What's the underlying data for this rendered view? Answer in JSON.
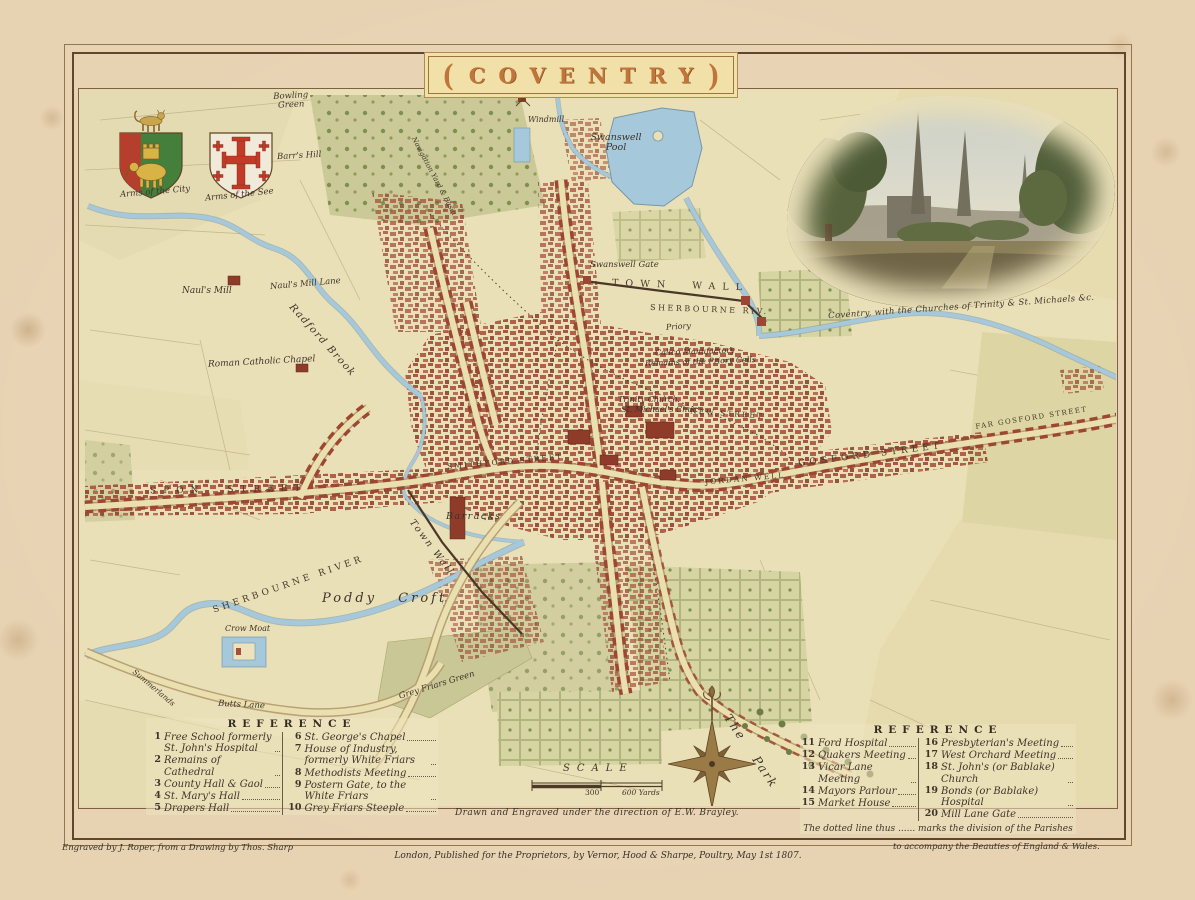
{
  "palette": {
    "paper": "#e7d2b2",
    "map_ground": "#eae0b8",
    "buildings": "#a5503a",
    "water": "#a6c8db",
    "greens": "#b9bf8a",
    "frame_ink": "#5f462c",
    "banner_text": "#c0763a",
    "label_ink": "#3e342a"
  },
  "title_banner": {
    "left_bracket": "(",
    "text": "COVENTRY",
    "right_bracket": ")"
  },
  "arms": {
    "city_label": "Arms of the City",
    "see_label": "Arms of the See"
  },
  "vignette": {
    "caption": "Coventry, with the Churches of Trinity & St. Michaels &c."
  },
  "map_labels": {
    "bowling_green": "Bowling Green",
    "barrs_hill": "Barr's Hill",
    "windmill": "Windmill",
    "swanswell_pool": "Swanswell Pool",
    "navigation_yard": "Navigation Yard & Basin",
    "nauls_mill": "Naul's Mill",
    "nauls_mill_lane": "Naul's Mill Lane",
    "radford_brook": "Radford Brook",
    "roman_catholic_chapel": "Roman Catholic Chapel",
    "swanswell_gate": "Swanswell Gate",
    "town_wall_north": "TOWN WALL",
    "sherbourne_riv": "SHERBOURNE RIV.",
    "priory": "Priory",
    "calico_manufactory": "Calico Manufactory",
    "priory_cells": "Remains of the Priory Cells",
    "trinity_church": "Trinity Church",
    "st_michaels": "St. Michael's Chur.",
    "new_street": "NEW STREET",
    "spon_street": "SPON STREET",
    "smithford_street": "SMITHFORD STREET",
    "jordan_well": "JORDAN WELL",
    "gosford_street": "GOSFORD STREET",
    "far_gosford_street": "FAR GOSFORD STREET",
    "barracks": "Barracks",
    "town_wall_south": "Town Wall",
    "sherbourne_river": "SHERBOURNE RIVER",
    "poddy_croft": "Poddy Croft",
    "crow_moat": "Crow Moat",
    "summerlands": "Summerlands",
    "butts_lane": "Butts Lane",
    "grey_friars_green": "Grey Friars Green",
    "the_park": "The Park"
  },
  "scale": {
    "title": "SCALE",
    "mid_value": "300",
    "end_value": "600 Yards"
  },
  "reference_left": {
    "title": "REFERENCE",
    "col1": [
      {
        "num": "1",
        "text": "Free School formerly St. John's Hospital"
      },
      {
        "num": "2",
        "text": "Remains of Cathedral"
      },
      {
        "num": "3",
        "text": "County Hall & Gaol"
      },
      {
        "num": "4",
        "text": "St. Mary's Hall"
      },
      {
        "num": "5",
        "text": "Drapers Hall"
      }
    ],
    "col2": [
      {
        "num": "6",
        "text": "St. George's Chapel"
      },
      {
        "num": "7",
        "text": "House of Industry, formerly White Friars"
      },
      {
        "num": "8",
        "text": "Methodists Meeting"
      },
      {
        "num": "9",
        "text": "Postern Gate, to the White Friars"
      },
      {
        "num": "10",
        "text": "Grey Friars Steeple"
      }
    ]
  },
  "reference_right": {
    "title": "REFERENCE",
    "col1": [
      {
        "num": "11",
        "text": "Ford Hospital"
      },
      {
        "num": "12",
        "text": "Quakers Meeting"
      },
      {
        "num": "13",
        "text": "Vicar Lane Meeting"
      },
      {
        "num": "14",
        "text": "Mayors Parlour"
      },
      {
        "num": "15",
        "text": "Market House"
      }
    ],
    "col2": [
      {
        "num": "16",
        "text": "Presbyterian's Meeting"
      },
      {
        "num": "17",
        "text": "West Orchard Meeting"
      },
      {
        "num": "18",
        "text": "St. John's (or Bablake) Church"
      },
      {
        "num": "19",
        "text": "Bonds (or Bablake) Hospital"
      },
      {
        "num": "20",
        "text": "Mill Lane Gate"
      }
    ],
    "note": "The dotted line thus ...... marks the division of the Parishes"
  },
  "credits": {
    "direction": "Drawn and Engraved under the direction of E.W. Brayley.",
    "engraver": "Engraved by J. Roper, from a Drawing by Thos. Sharp",
    "publisher": "London, Published for the Proprietors, by Vernor, Hood & Sharpe, Poultry, May 1st 1807.",
    "series": "to accompany the Beauties of England & Wales."
  }
}
